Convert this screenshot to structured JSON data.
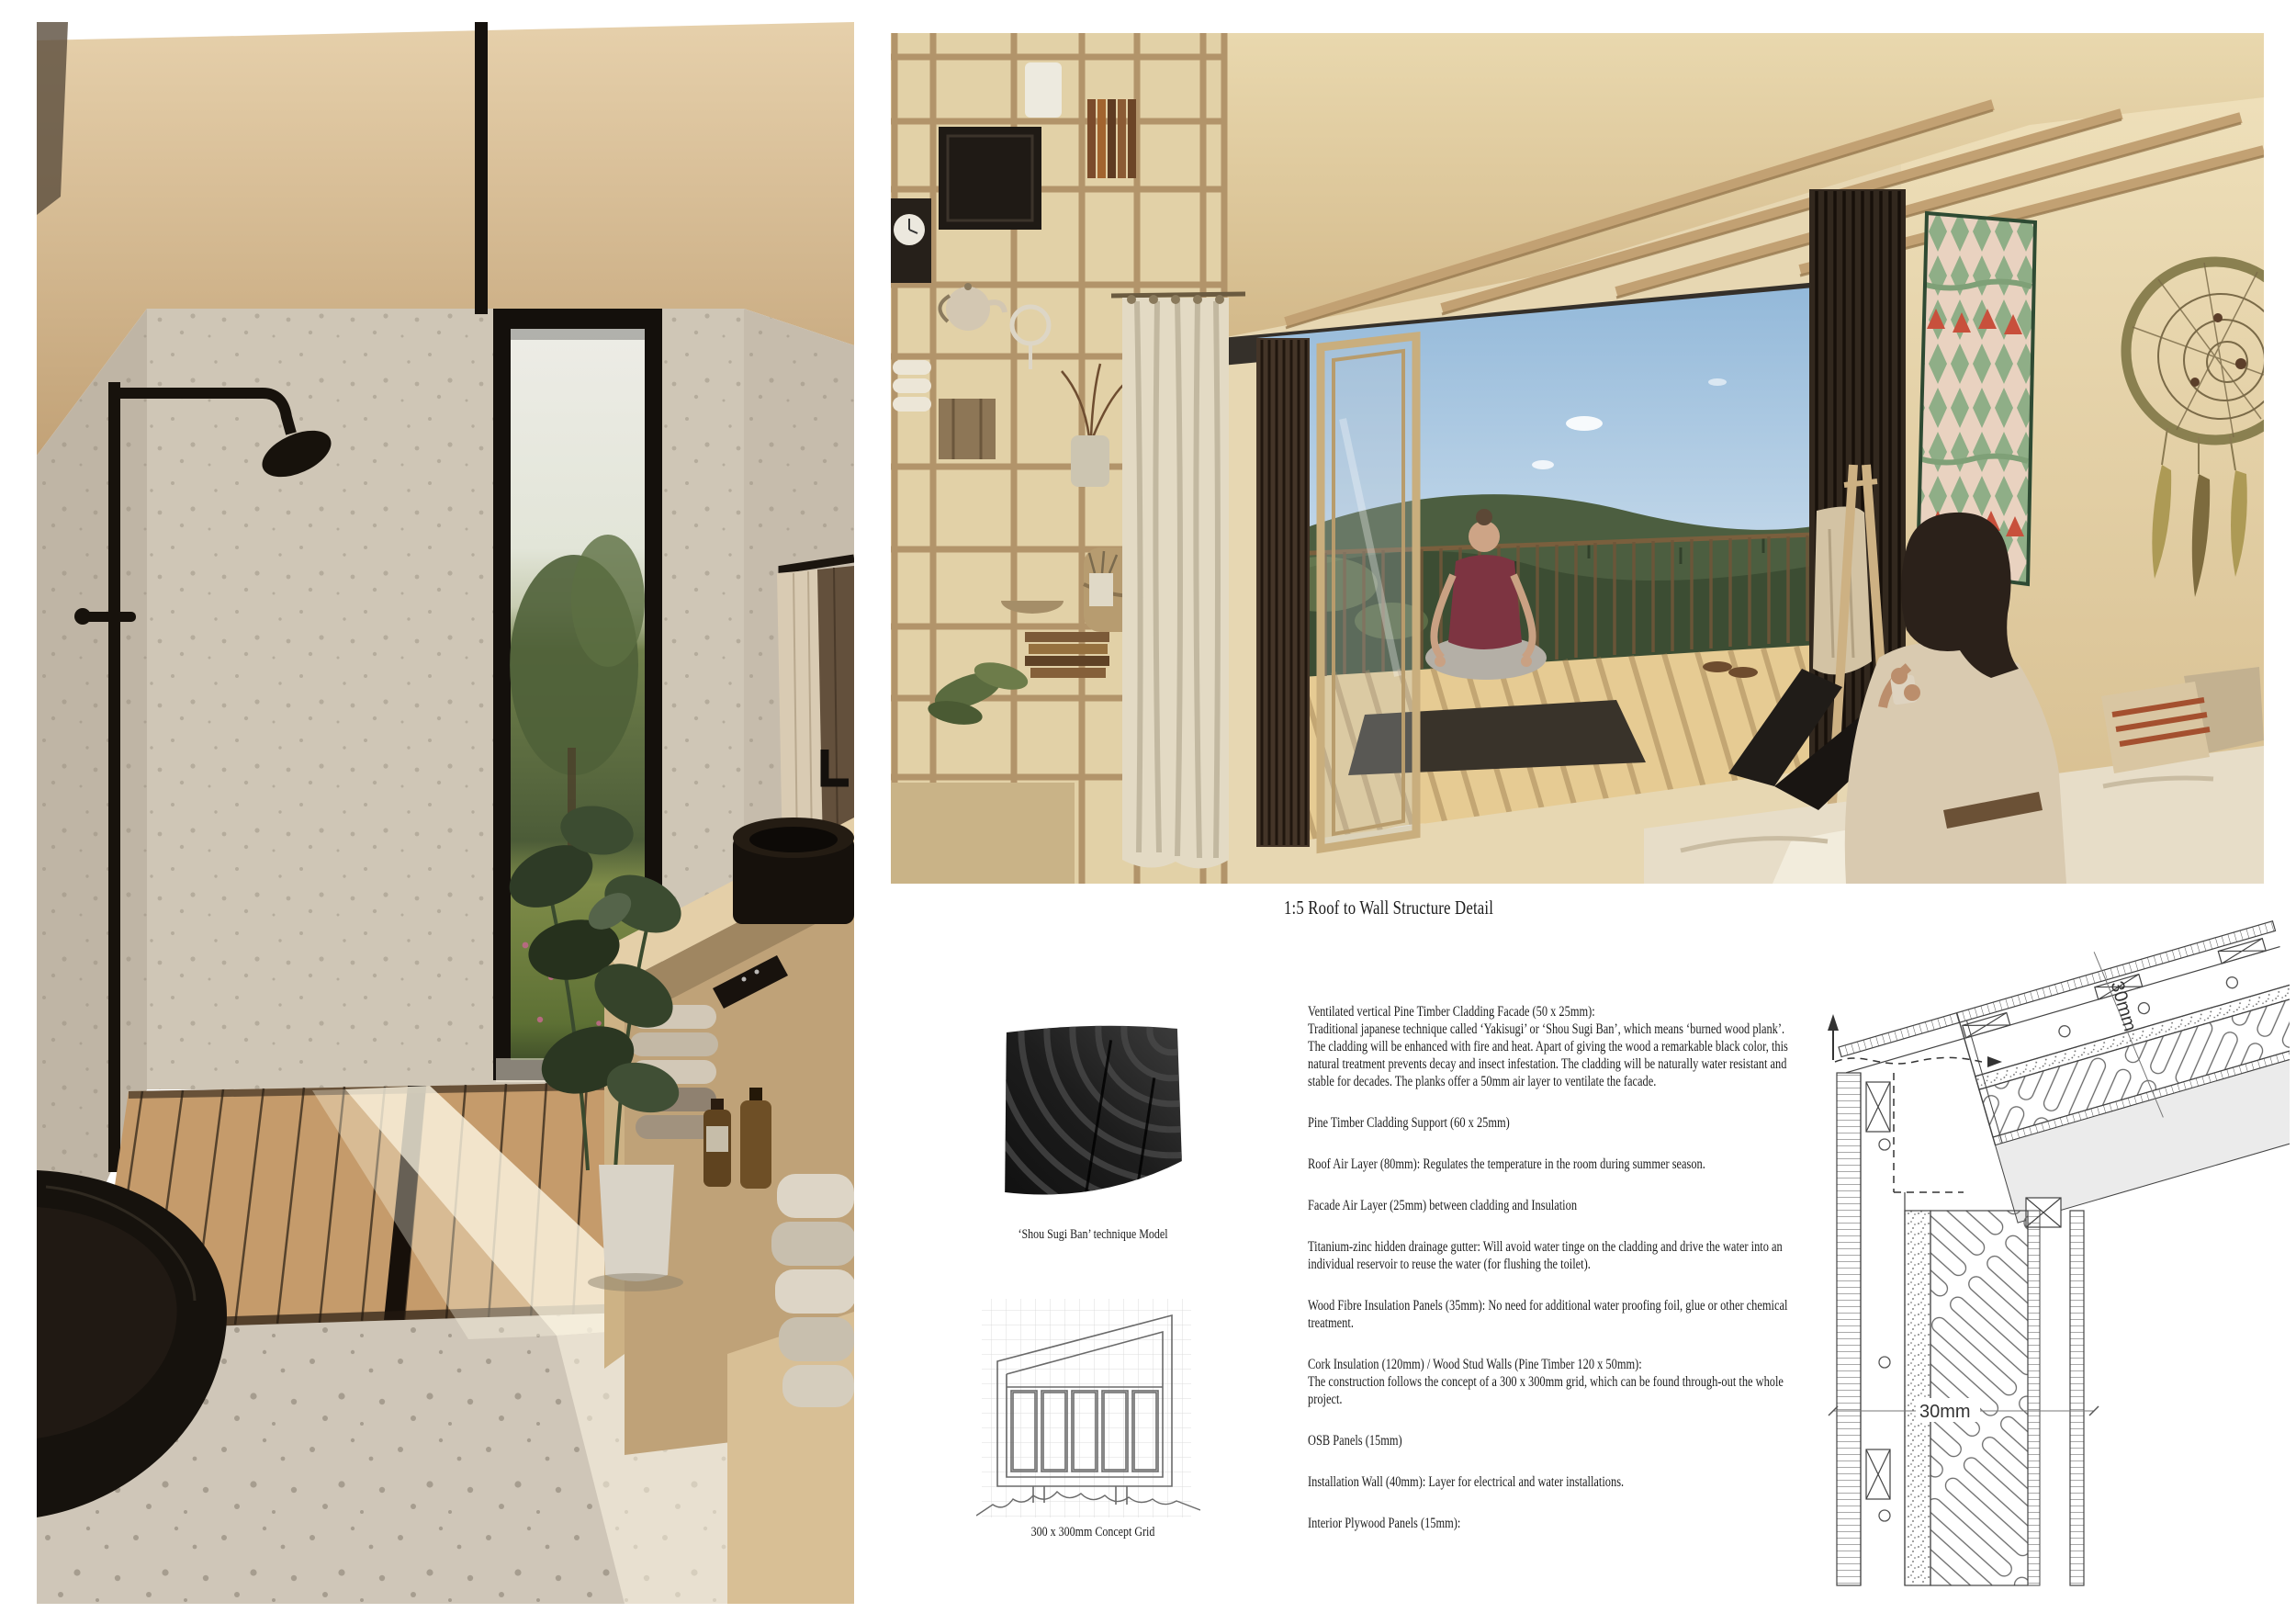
{
  "board": {
    "title": "1:5 Roof to Wall Structure Detail",
    "model_caption": "‘Shou Sugi Ban’ technique Model",
    "grid_caption": "300 x 300mm Concept Grid",
    "notes": [
      "Ventilated vertical Pine Timber Cladding Facade (50 x 25mm):\nTraditional japanese technique called ‘Yakisugi’ or ‘Shou Sugi Ban’, which means ‘burned wood plank’. The cladding will be enhanced with fire and heat. Apart of giving the wood a remarkable black color, this natural treatment prevents decay and insect infestation. The cladding will be naturally water resistant and stable for decades. The planks offer a 50mm air layer to ventilate the facade.",
      "Pine Timber Cladding Support (60 x 25mm)",
      "Roof Air Layer (80mm): Regulates the temperature in the room during summer season.",
      "Facade Air Layer (25mm) between cladding and Insulation",
      "Titanium-zinc hidden drainage gutter: Will avoid water tinge on the cladding and drive the water into an individual reservoir to reuse the water (for flushing the toilet).",
      "Wood Fibre Insulation Panels (35mm): No need for additional water proofing foil, glue or other chemical treatment.",
      "Cork Insulation (120mm) / Wood Stud Walls (Pine Timber 120 x 50mm):\nThe construction follows the concept of a 300 x 300mm grid, which can be found through-out the whole project.",
      "OSB Panels (15mm)",
      "Installation Wall (40mm): Layer for electrical and water installations.",
      "Interior Plywood Panels (15mm):"
    ],
    "drawing": {
      "roof_gap_label": "30mm",
      "wall_gap_label": "30mm"
    },
    "palette": {
      "plywood": "#dcc49a",
      "concrete": "#c7beb0",
      "charcoal": "#17130f",
      "sky": "#9fc3de",
      "forest": "#45573a",
      "tapestry_green": "#8fae87",
      "tapestry_red": "#c8503c"
    }
  }
}
